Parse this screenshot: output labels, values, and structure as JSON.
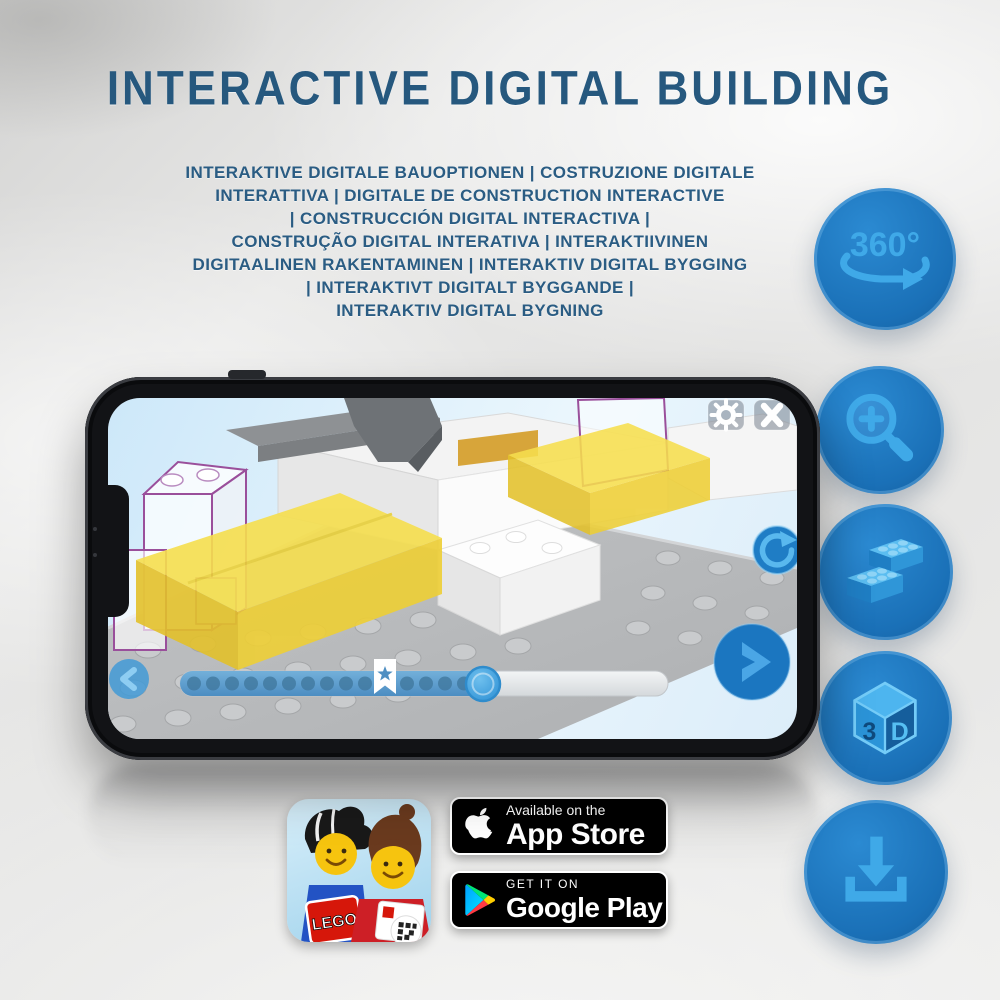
{
  "header": {
    "title": "INTERACTIVE DIGITAL BUILDING",
    "subtitle_lines": [
      "INTERAKTIVE DIGITALE BAUOPTIONEN | COSTRUZIONE DIGITALE",
      "INTERATTIVA | DIGITALE DE CONSTRUCTION INTERACTIVE",
      "| CONSTRUCCIÓN DIGITAL INTERACTIVA |",
      "CONSTRUÇÃO DIGITAL INTERATIVA | INTERAKTIIVINEN",
      "DIGITAALINEN RAKENTAMINEN | INTERAKTIV DIGITAL BYGGING",
      "| INTERAKTIVT DIGITALT BYGGANDE |",
      "INTERAKTIV DIGITAL BYGNING"
    ]
  },
  "features": [
    {
      "id": "rotation-360",
      "icon": "rotate-360-icon",
      "label": "360°"
    },
    {
      "id": "zoom-in",
      "icon": "zoom-in-icon"
    },
    {
      "id": "digital-bricks",
      "icon": "bricks-icon"
    },
    {
      "id": "view-3d",
      "icon": "cube-3d-icon",
      "left_label": "3",
      "right_label": "D"
    },
    {
      "id": "download",
      "icon": "download-icon"
    }
  ],
  "phone_app": {
    "controls": {
      "settings": "gear-icon",
      "close": "close-icon",
      "rotate": "rotate-icon",
      "previous": "chevron-left-icon",
      "next": "chevron-right-icon"
    },
    "progress": {
      "marker": "star-bookmark",
      "filled_fraction": 0.62
    },
    "scene": "lego-3d-building-instructions"
  },
  "badges": {
    "lego": {
      "label": "LEGO"
    },
    "app_store": {
      "tagline": "Available on the",
      "store": "App Store"
    },
    "google_play": {
      "tagline": "GET IT ON",
      "store": "Google Play"
    }
  },
  "colors": {
    "title": "#26587e",
    "circle_blue": "#1a70b7",
    "icon_light_blue": "#3fa9e8",
    "brick_yellow": "#f2d83e",
    "ghost_outline_purple": "#9a4f9b",
    "badge_black": "#000000"
  }
}
